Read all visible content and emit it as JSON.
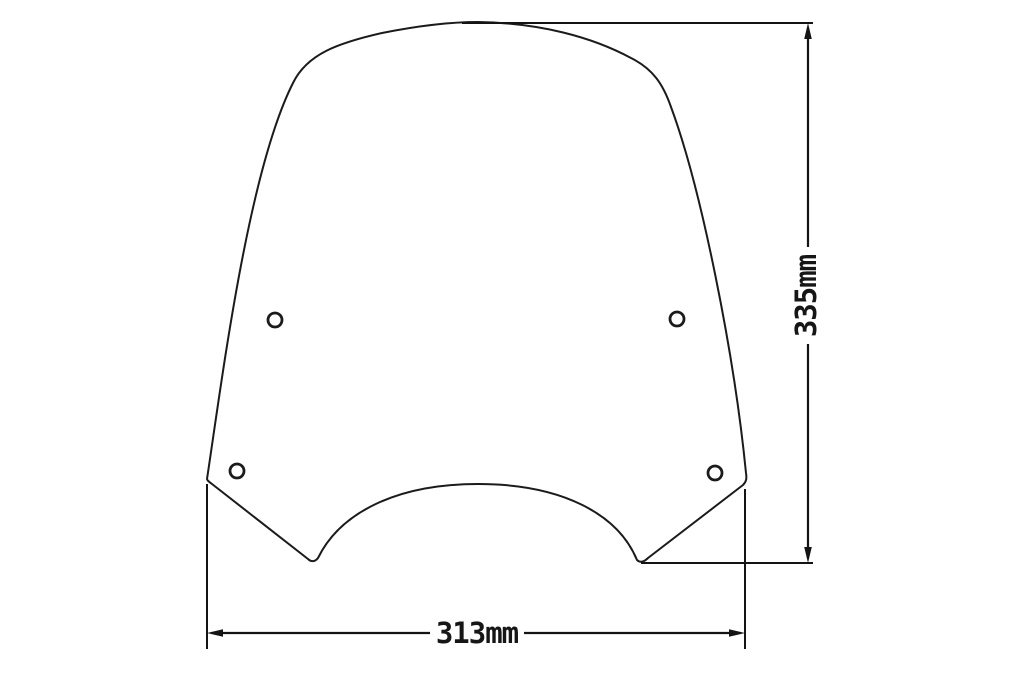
{
  "canvas": {
    "background": "#ffffff",
    "line_color": "#1b1b1b"
  },
  "drawing": {
    "name": "windscreen-dimensional-drawing",
    "mounting_holes_count": 4,
    "height_dimension": {
      "label": "335mm"
    },
    "width_dimension": {
      "label": "313mm"
    }
  }
}
